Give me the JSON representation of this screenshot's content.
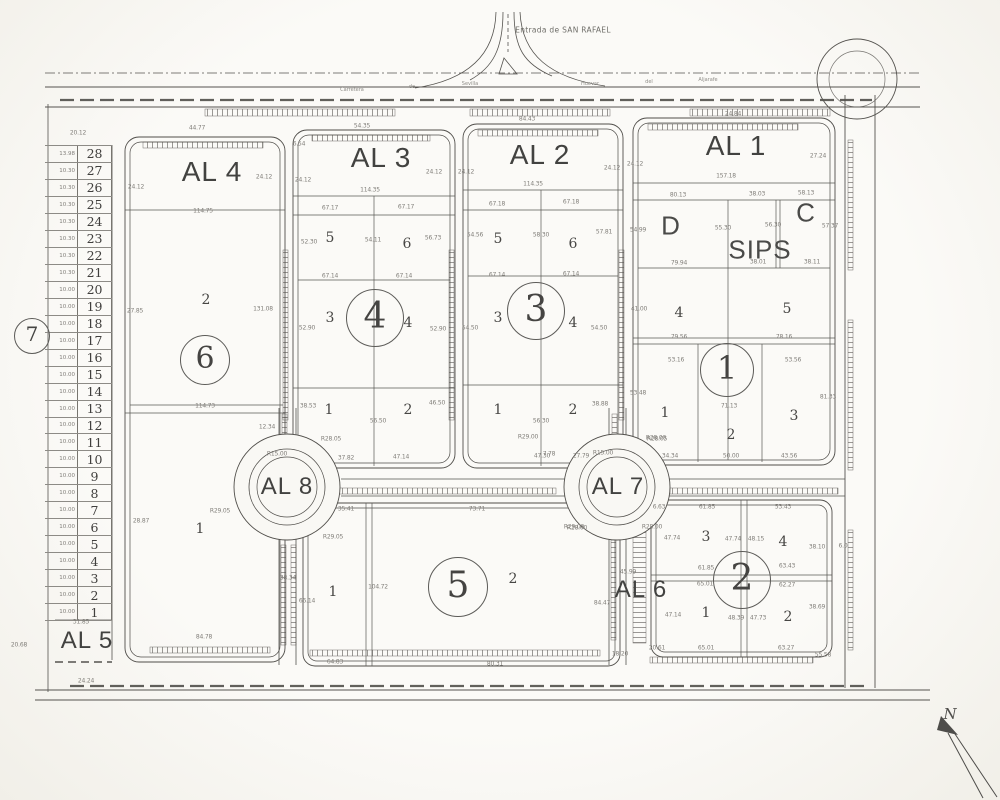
{
  "sheet": {
    "bg": "#f9f8f4",
    "ink": "#4b4b4b",
    "dim_color": "#807e79"
  },
  "header": {
    "road_title": "Entrada de SAN RAFAEL",
    "road_words": [
      {
        "t": "Carretera",
        "x": 352,
        "y": 90
      },
      {
        "t": "de",
        "x": 412,
        "y": 87
      },
      {
        "t": "Sevilla",
        "x": 470,
        "y": 84
      },
      {
        "t": "Huevar",
        "x": 590,
        "y": 84
      },
      {
        "t": "del",
        "x": 649,
        "y": 82
      },
      {
        "t": "Aljarafe",
        "x": 708,
        "y": 80
      }
    ]
  },
  "north": {
    "label": "N"
  },
  "block_titles": [
    {
      "t": "AL 4",
      "x": 212,
      "y": 172,
      "fs": 28
    },
    {
      "t": "AL 3",
      "x": 381,
      "y": 158,
      "fs": 28
    },
    {
      "t": "AL 2",
      "x": 540,
      "y": 155,
      "fs": 28
    },
    {
      "t": "AL 1",
      "x": 736,
      "y": 146,
      "fs": 28
    },
    {
      "t": "AL 8",
      "x": 287,
      "y": 487,
      "fs": 24
    },
    {
      "t": "AL 7",
      "x": 618,
      "y": 487,
      "fs": 24
    },
    {
      "t": "AL 6",
      "x": 641,
      "y": 590,
      "fs": 24
    },
    {
      "t": "AL 5",
      "x": 87,
      "y": 641,
      "fs": 24
    }
  ],
  "letters": [
    {
      "t": "D",
      "x": 671,
      "y": 226,
      "fs": 26
    },
    {
      "t": "C",
      "x": 806,
      "y": 213,
      "fs": 26
    },
    {
      "t": "SIPS",
      "x": 760,
      "y": 250,
      "fs": 26
    }
  ],
  "circled_numbers": [
    {
      "t": "7",
      "x": 32,
      "y": 336,
      "r": 17,
      "fs": 20
    },
    {
      "t": "6",
      "x": 205,
      "y": 360,
      "r": 24,
      "fs": 30
    },
    {
      "t": "4",
      "x": 375,
      "y": 318,
      "r": 28,
      "fs": 36
    },
    {
      "t": "3",
      "x": 536,
      "y": 311,
      "r": 28,
      "fs": 36
    },
    {
      "t": "1",
      "x": 727,
      "y": 370,
      "r": 26,
      "fs": 32
    },
    {
      "t": "5",
      "x": 458,
      "y": 587,
      "r": 29,
      "fs": 36
    },
    {
      "t": "2",
      "x": 742,
      "y": 580,
      "r": 28,
      "fs": 36
    }
  ],
  "parcel_numbers": [
    {
      "t": "2",
      "x": 206,
      "y": 300
    },
    {
      "t": "1",
      "x": 200,
      "y": 529
    },
    {
      "t": "5",
      "x": 330,
      "y": 238
    },
    {
      "t": "6",
      "x": 407,
      "y": 244
    },
    {
      "t": "3",
      "x": 330,
      "y": 318
    },
    {
      "t": "4",
      "x": 408,
      "y": 323
    },
    {
      "t": "1",
      "x": 329,
      "y": 410
    },
    {
      "t": "2",
      "x": 408,
      "y": 410
    },
    {
      "t": "5",
      "x": 498,
      "y": 239
    },
    {
      "t": "6",
      "x": 573,
      "y": 244
    },
    {
      "t": "3",
      "x": 498,
      "y": 318
    },
    {
      "t": "4",
      "x": 573,
      "y": 323
    },
    {
      "t": "1",
      "x": 498,
      "y": 410
    },
    {
      "t": "2",
      "x": 573,
      "y": 410
    },
    {
      "t": "4",
      "x": 679,
      "y": 313
    },
    {
      "t": "5",
      "x": 787,
      "y": 309
    },
    {
      "t": "1",
      "x": 665,
      "y": 413
    },
    {
      "t": "2",
      "x": 731,
      "y": 435
    },
    {
      "t": "3",
      "x": 794,
      "y": 416
    },
    {
      "t": "1",
      "x": 333,
      "y": 592
    },
    {
      "t": "2",
      "x": 513,
      "y": 579
    },
    {
      "t": "3",
      "x": 706,
      "y": 537
    },
    {
      "t": "4",
      "x": 783,
      "y": 542
    },
    {
      "t": "1",
      "x": 706,
      "y": 613
    },
    {
      "t": "2",
      "x": 788,
      "y": 617
    }
  ],
  "dimensions": [
    {
      "t": "20.12",
      "x": 78,
      "y": 133
    },
    {
      "t": "44.77",
      "x": 197,
      "y": 128
    },
    {
      "t": "54.35",
      "x": 362,
      "y": 126
    },
    {
      "t": "84.43",
      "x": 527,
      "y": 119
    },
    {
      "t": "24.84",
      "x": 733,
      "y": 114
    },
    {
      "t": "24.12",
      "x": 136,
      "y": 187
    },
    {
      "t": "24.12",
      "x": 264,
      "y": 177
    },
    {
      "t": "114.75",
      "x": 203,
      "y": 211
    },
    {
      "t": "27.85",
      "x": 135,
      "y": 311
    },
    {
      "t": "131.08",
      "x": 263,
      "y": 309
    },
    {
      "t": "114.73",
      "x": 205,
      "y": 406
    },
    {
      "t": "12.34",
      "x": 267,
      "y": 427
    },
    {
      "t": "28.87",
      "x": 141,
      "y": 521
    },
    {
      "t": "38.34",
      "x": 288,
      "y": 578
    },
    {
      "t": "84.78",
      "x": 204,
      "y": 637
    },
    {
      "t": "20.68",
      "x": 19,
      "y": 645
    },
    {
      "t": "31.85",
      "x": 81,
      "y": 622
    },
    {
      "t": "24.24",
      "x": 86,
      "y": 681
    },
    {
      "t": "6.54",
      "x": 299,
      "y": 144
    },
    {
      "t": "24.12",
      "x": 303,
      "y": 180
    },
    {
      "t": "24.12",
      "x": 434,
      "y": 172
    },
    {
      "t": "114.35",
      "x": 370,
      "y": 190
    },
    {
      "t": "67.17",
      "x": 330,
      "y": 208
    },
    {
      "t": "67.17",
      "x": 406,
      "y": 207
    },
    {
      "t": "52.30",
      "x": 309,
      "y": 242
    },
    {
      "t": "54.11",
      "x": 373,
      "y": 240
    },
    {
      "t": "56.73",
      "x": 433,
      "y": 238
    },
    {
      "t": "67.14",
      "x": 330,
      "y": 276
    },
    {
      "t": "67.14",
      "x": 404,
      "y": 276
    },
    {
      "t": "52.90",
      "x": 307,
      "y": 328
    },
    {
      "t": "52.90",
      "x": 438,
      "y": 329
    },
    {
      "t": "38.53",
      "x": 308,
      "y": 406
    },
    {
      "t": "56.50",
      "x": 378,
      "y": 421
    },
    {
      "t": "46.50",
      "x": 437,
      "y": 403
    },
    {
      "t": "R28.05",
      "x": 331,
      "y": 439
    },
    {
      "t": "37.82",
      "x": 346,
      "y": 458
    },
    {
      "t": "47.14",
      "x": 401,
      "y": 457
    },
    {
      "t": "24.12",
      "x": 466,
      "y": 172
    },
    {
      "t": "24.12",
      "x": 612,
      "y": 168
    },
    {
      "t": "114.35",
      "x": 533,
      "y": 184
    },
    {
      "t": "67.18",
      "x": 497,
      "y": 204
    },
    {
      "t": "67.18",
      "x": 571,
      "y": 202
    },
    {
      "t": "54.56",
      "x": 475,
      "y": 235
    },
    {
      "t": "58.30",
      "x": 541,
      "y": 235
    },
    {
      "t": "57.81",
      "x": 604,
      "y": 232
    },
    {
      "t": "67.14",
      "x": 497,
      "y": 275
    },
    {
      "t": "67.14",
      "x": 571,
      "y": 274
    },
    {
      "t": "54.50",
      "x": 470,
      "y": 328
    },
    {
      "t": "54.50",
      "x": 599,
      "y": 328
    },
    {
      "t": "56.30",
      "x": 541,
      "y": 421
    },
    {
      "t": "38.88",
      "x": 600,
      "y": 404
    },
    {
      "t": "R29.00",
      "x": 528,
      "y": 437
    },
    {
      "t": "47.30",
      "x": 542,
      "y": 456
    },
    {
      "t": "27.79",
      "x": 581,
      "y": 456
    },
    {
      "t": "24.12",
      "x": 635,
      "y": 164
    },
    {
      "t": "157.18",
      "x": 726,
      "y": 176
    },
    {
      "t": "27.24",
      "x": 818,
      "y": 156
    },
    {
      "t": "80.13",
      "x": 678,
      "y": 195
    },
    {
      "t": "38.03",
      "x": 757,
      "y": 194
    },
    {
      "t": "58.13",
      "x": 806,
      "y": 193
    },
    {
      "t": "54.99",
      "x": 638,
      "y": 230
    },
    {
      "t": "55.30",
      "x": 723,
      "y": 228
    },
    {
      "t": "56.30",
      "x": 773,
      "y": 225
    },
    {
      "t": "57.37",
      "x": 830,
      "y": 226
    },
    {
      "t": "79.94",
      "x": 679,
      "y": 263
    },
    {
      "t": "38.01",
      "x": 758,
      "y": 262
    },
    {
      "t": "38.11",
      "x": 812,
      "y": 262
    },
    {
      "t": "41.00",
      "x": 639,
      "y": 309
    },
    {
      "t": "79.56",
      "x": 679,
      "y": 337
    },
    {
      "t": "78.16",
      "x": 784,
      "y": 337
    },
    {
      "t": "53.16",
      "x": 676,
      "y": 360
    },
    {
      "t": "53.56",
      "x": 793,
      "y": 360
    },
    {
      "t": "53.48",
      "x": 638,
      "y": 393
    },
    {
      "t": "71.13",
      "x": 729,
      "y": 406
    },
    {
      "t": "81.33",
      "x": 828,
      "y": 397
    },
    {
      "t": "R28.05",
      "x": 657,
      "y": 439
    },
    {
      "t": "34.34",
      "x": 670,
      "y": 456
    },
    {
      "t": "50.00",
      "x": 731,
      "y": 456
    },
    {
      "t": "43.56",
      "x": 789,
      "y": 456
    },
    {
      "t": "R15.00",
      "x": 277,
      "y": 454
    },
    {
      "t": "R29.05",
      "x": 220,
      "y": 511
    },
    {
      "t": "R29.05",
      "x": 333,
      "y": 537
    },
    {
      "t": "R15.00",
      "x": 603,
      "y": 453
    },
    {
      "t": "R28.00",
      "x": 656,
      "y": 438
    },
    {
      "t": "7.78",
      "x": 549,
      "y": 454
    },
    {
      "t": "R29.00",
      "x": 574,
      "y": 527
    },
    {
      "t": "35.41",
      "x": 346,
      "y": 509
    },
    {
      "t": "73.71",
      "x": 477,
      "y": 509
    },
    {
      "t": "R28.00",
      "x": 577,
      "y": 528
    },
    {
      "t": "66.14",
      "x": 307,
      "y": 601
    },
    {
      "t": "104.72",
      "x": 378,
      "y": 587
    },
    {
      "t": "84.47",
      "x": 602,
      "y": 603
    },
    {
      "t": "64.83",
      "x": 335,
      "y": 662
    },
    {
      "t": "80.31",
      "x": 495,
      "y": 664
    },
    {
      "t": "6.63",
      "x": 659,
      "y": 507
    },
    {
      "t": "61.85",
      "x": 707,
      "y": 507
    },
    {
      "t": "53.43",
      "x": 783,
      "y": 507
    },
    {
      "t": "R28.00",
      "x": 652,
      "y": 527
    },
    {
      "t": "47.74",
      "x": 672,
      "y": 538
    },
    {
      "t": "47.74",
      "x": 733,
      "y": 539
    },
    {
      "t": "48.15",
      "x": 756,
      "y": 539
    },
    {
      "t": "38.10",
      "x": 817,
      "y": 547
    },
    {
      "t": "61.85",
      "x": 706,
      "y": 568
    },
    {
      "t": "63.43",
      "x": 787,
      "y": 566
    },
    {
      "t": "65.01",
      "x": 705,
      "y": 584
    },
    {
      "t": "62.27",
      "x": 787,
      "y": 585
    },
    {
      "t": "47.14",
      "x": 673,
      "y": 615
    },
    {
      "t": "48.39",
      "x": 736,
      "y": 618
    },
    {
      "t": "47.73",
      "x": 758,
      "y": 618
    },
    {
      "t": "38.69",
      "x": 817,
      "y": 607
    },
    {
      "t": "20.61",
      "x": 657,
      "y": 648
    },
    {
      "t": "65.01",
      "x": 706,
      "y": 648
    },
    {
      "t": "63.27",
      "x": 786,
      "y": 648
    },
    {
      "t": "45.99",
      "x": 628,
      "y": 572
    },
    {
      "t": "18.20",
      "x": 620,
      "y": 654
    },
    {
      "t": "55.58",
      "x": 823,
      "y": 655
    },
    {
      "t": "6.0",
      "x": 843,
      "y": 546
    }
  ],
  "lot_strip": {
    "al5_label": "AL 5",
    "circle_label": "7",
    "rows": [
      {
        "n": "28",
        "w": "13.98"
      },
      {
        "n": "27",
        "w": "10.30"
      },
      {
        "n": "26",
        "w": "10.30"
      },
      {
        "n": "25",
        "w": "10.30"
      },
      {
        "n": "24",
        "w": "10.30"
      },
      {
        "n": "23",
        "w": "10.30"
      },
      {
        "n": "22",
        "w": "10.30"
      },
      {
        "n": "21",
        "w": "10.30"
      },
      {
        "n": "20",
        "w": "10.00"
      },
      {
        "n": "19",
        "w": "10.00"
      },
      {
        "n": "18",
        "w": "10.00"
      },
      {
        "n": "17",
        "w": "10.00"
      },
      {
        "n": "16",
        "w": "10.00"
      },
      {
        "n": "15",
        "w": "10.00"
      },
      {
        "n": "14",
        "w": "10.00"
      },
      {
        "n": "13",
        "w": "10.00"
      },
      {
        "n": "12",
        "w": "10.00"
      },
      {
        "n": "11",
        "w": "10.00"
      },
      {
        "n": "10",
        "w": "10.00"
      },
      {
        "n": "9",
        "w": "10.00"
      },
      {
        "n": "8",
        "w": "10.00"
      },
      {
        "n": "7",
        "w": "10.00"
      },
      {
        "n": "6",
        "w": "10.00"
      },
      {
        "n": "5",
        "w": "10.00"
      },
      {
        "n": "4",
        "w": "10.00"
      },
      {
        "n": "3",
        "w": "10.00"
      },
      {
        "n": "2",
        "w": "10.00"
      },
      {
        "n": "1",
        "w": "10.00"
      }
    ]
  }
}
